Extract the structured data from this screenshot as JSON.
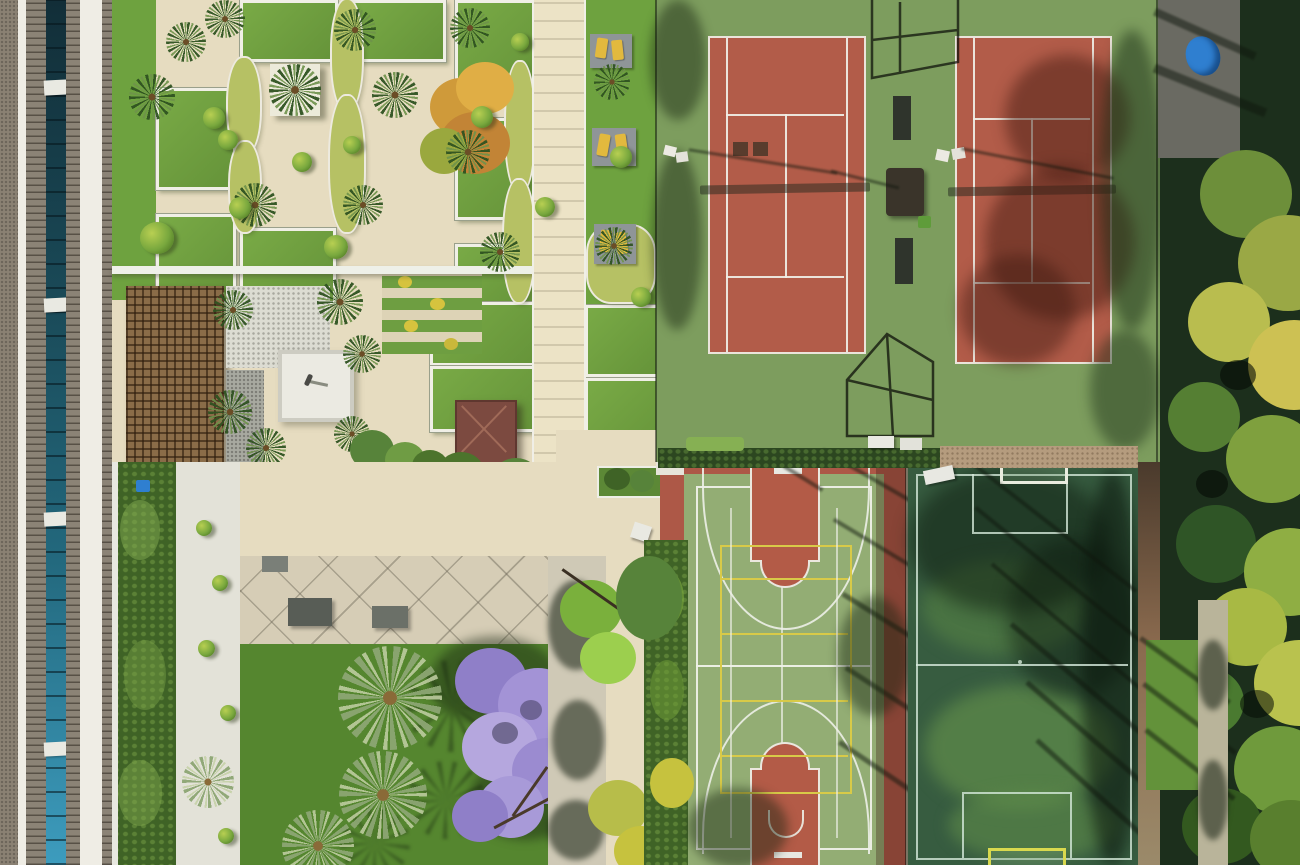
{
  "scene": {
    "type": "aerial-drone-photograph",
    "setting": "resort garden and sports complex viewed from directly above",
    "regions": [
      {
        "name": "apartment-building-roofline",
        "position": "left edge"
      },
      {
        "name": "formal-parterre-garden",
        "position": "top left"
      },
      {
        "name": "timber-pergola",
        "position": "mid left"
      },
      {
        "name": "paved-plaza-with-gazebo",
        "position": "center left"
      },
      {
        "name": "lower-lawn-with-palms",
        "position": "bottom left"
      },
      {
        "name": "jacaranda-tree",
        "position": "bottom center-left"
      },
      {
        "name": "tennis-court-1",
        "position": "top center"
      },
      {
        "name": "tennis-court-2",
        "position": "top right"
      },
      {
        "name": "multisport-basketball-court",
        "position": "bottom center"
      },
      {
        "name": "five-a-side-football-pitch",
        "position": "bottom right"
      },
      {
        "name": "tree-canopy-strip",
        "position": "right edge"
      },
      {
        "name": "blue-tarp",
        "position": "top right corner"
      }
    ]
  },
  "palette": {
    "building-gravel": "#8a8173",
    "building-white": "#efede5",
    "building-louver": "#8b8376",
    "building-glass-dark": "#122e38",
    "building-glass-light": "#3d9cbe",
    "garden-paving": "#e6dcc0",
    "path-light": "#ece3c6",
    "lawn-green": "#6ea23f",
    "curb-white": "#f0efe6",
    "bed-green": "#b6c164",
    "topiary-green": "#79a83e",
    "lounger-yellow": "#e2b93e",
    "pergola-wood": "#8a6c48",
    "gravel-white": "#dcdcd2",
    "gravel-grey": "#a8a9a0",
    "patio-concrete": "#d6cdb6",
    "gazebo-roof": "#7c4a40",
    "tennis-surround": "#7d9d5e",
    "tennis-clay": "#b25c49",
    "hedge-dark": "#3f6326",
    "tan-path": "#b59c7e",
    "bball-red": "#ad5847",
    "bball-green": "#93ad74",
    "bball-yellow": "#d8ca48",
    "pitch-green": "#375c40",
    "pitch-light": "#5d8a4a",
    "jacaranda-purple": "#a393d6",
    "tree-dark": "#1c2f1c",
    "tree-yellow": "#b9bd4f",
    "tree-green": "#557f33",
    "tarp-blue": "#2f7fd0",
    "lower-lawn": "#55862f"
  }
}
